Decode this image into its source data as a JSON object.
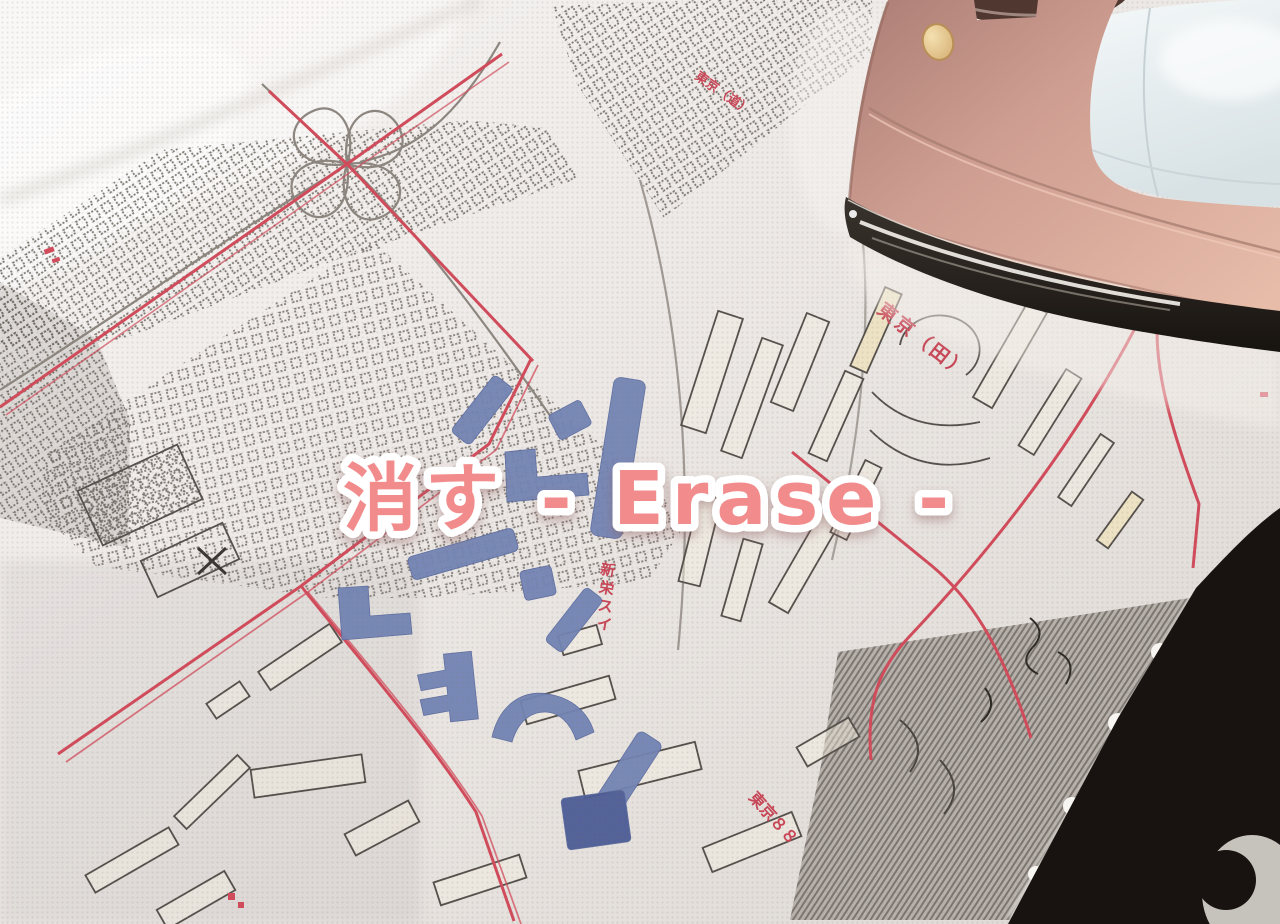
{
  "overlay": {
    "title": "消す - Erase -",
    "text_color": "#F28C8C",
    "outline_color": "#FFFFFF"
  },
  "fabric_map": {
    "kind": "cross-stitch-city-map-fabric",
    "base_color": "#ECE8E5",
    "line_color": "#6E6862",
    "road_color": "#D24B5B",
    "stitch_color": "#7384B4",
    "stitch_dark_color": "#4C5C96",
    "labels": {
      "top": "東京（道）",
      "right": "東京（田）",
      "vertical": [
        "新",
        "栄",
        "ス",
        "イ"
      ],
      "bottom": "東京８８"
    }
  },
  "iron": {
    "kind": "steam-iron-rose-gold",
    "body_color": "#CE9D91",
    "tank_color": "#E9EEEF",
    "button_color": "#EDD2A0",
    "handle_color": "#503830",
    "soleplate_color": "#26211C"
  },
  "background": {
    "corner_color": "#181310",
    "corner_object_color": "#C6C3BD"
  }
}
